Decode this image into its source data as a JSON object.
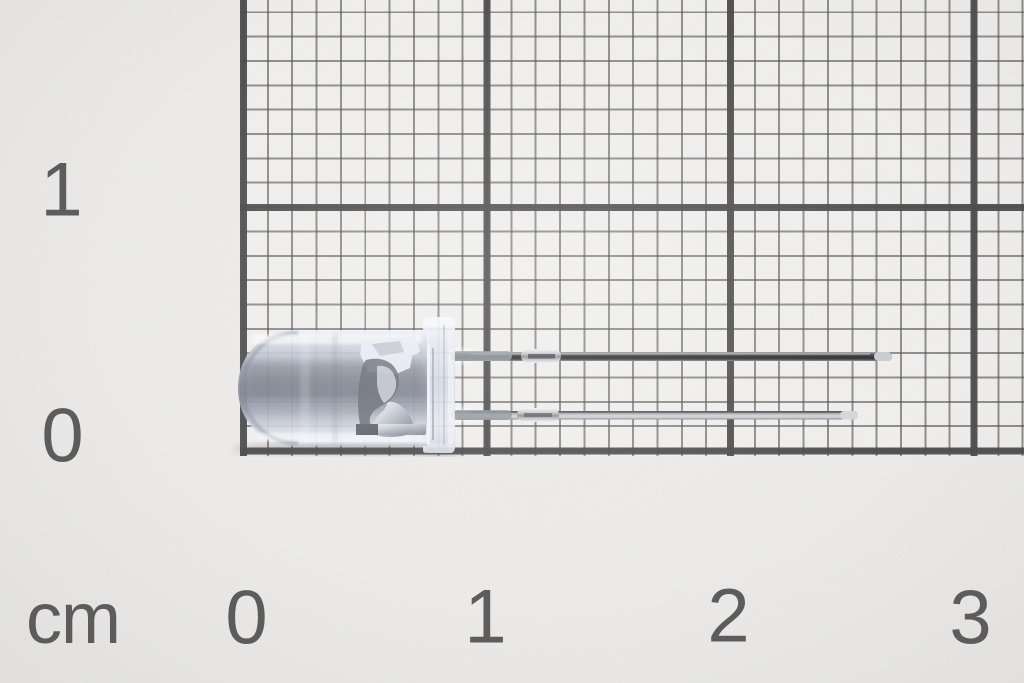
{
  "scene": {
    "type": "macro-photograph",
    "subject": "Clear 5 mm LED lying horizontally on millimeter graph paper with centimeter scale"
  },
  "ruler": {
    "unit": "cm",
    "bottom_labels": [
      "0",
      "1",
      "2",
      "3"
    ],
    "left_labels": [
      "1",
      "0"
    ]
  },
  "grid": {
    "minor_cell": "1 mm",
    "major_cell": "1 cm",
    "line_color": "#4a4a4a",
    "paper_color": "#ecebe9"
  },
  "led": {
    "description": "Transparent epoxy LED, dome tip pointing left, flange at base, two straight metal leads pointing right",
    "body_tint": "#9aa0ae",
    "flange_tint": "#d9deе9",
    "lead_dark_color": "#3a3b3d",
    "lead_silver_color": "#cfd2d6",
    "measurements_read_from_ruler": {
      "dome_tip_cm": 0.0,
      "flange_cm": 0.87,
      "top_lead_end_cm": 2.66,
      "bottom_lead_end_cm": 2.52
    }
  }
}
